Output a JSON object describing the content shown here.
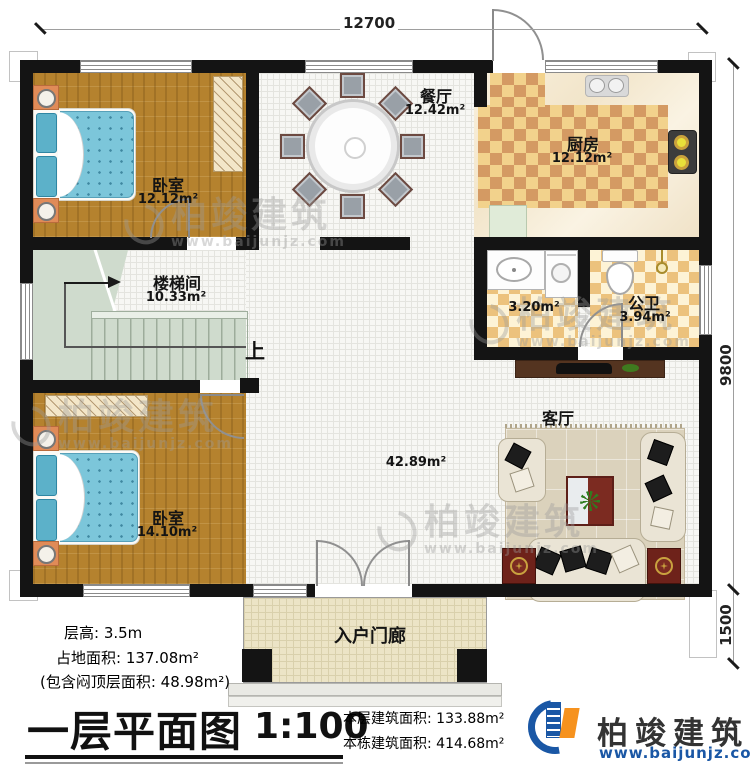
{
  "dimensions": {
    "top": "12700",
    "right_main": "9800",
    "right_porch": "1500"
  },
  "rooms": [
    {
      "name": "卧室",
      "area": "12.12m²"
    },
    {
      "name": "餐厅",
      "area": "12.42m²"
    },
    {
      "name": "厨房",
      "area": "12.12m²"
    },
    {
      "name": "楼梯间",
      "area": "10.33m²"
    },
    {
      "name": "",
      "area": "3.20m²"
    },
    {
      "name": "公卫",
      "area": "3.94m²"
    },
    {
      "name": "客厅",
      "area": "42.89m²"
    },
    {
      "name": "卧室",
      "area": "14.10m²"
    },
    {
      "name": "入户门廊",
      "area": ""
    }
  ],
  "labels": {
    "up": "上"
  },
  "title_block": {
    "floor_height": "层高: 3.5m",
    "land_area": "占地面积: 137.08m²",
    "attic_note": "(包含闷顶层面积: 48.98m²)",
    "title": "一层平面图",
    "scale": "1:100",
    "floor_area": "本层建筑面积: 133.88m²",
    "total_area": "本栋建筑面积: 414.68m²"
  },
  "brand": {
    "name": "柏竣建筑",
    "website": "www.baijunjz.com"
  },
  "colors": {
    "wall": "#141414",
    "brand_blue": "#1a57a5",
    "brand_orange": "#f6921e",
    "wood": "#b5822e",
    "stair": "#cfdbcd"
  }
}
